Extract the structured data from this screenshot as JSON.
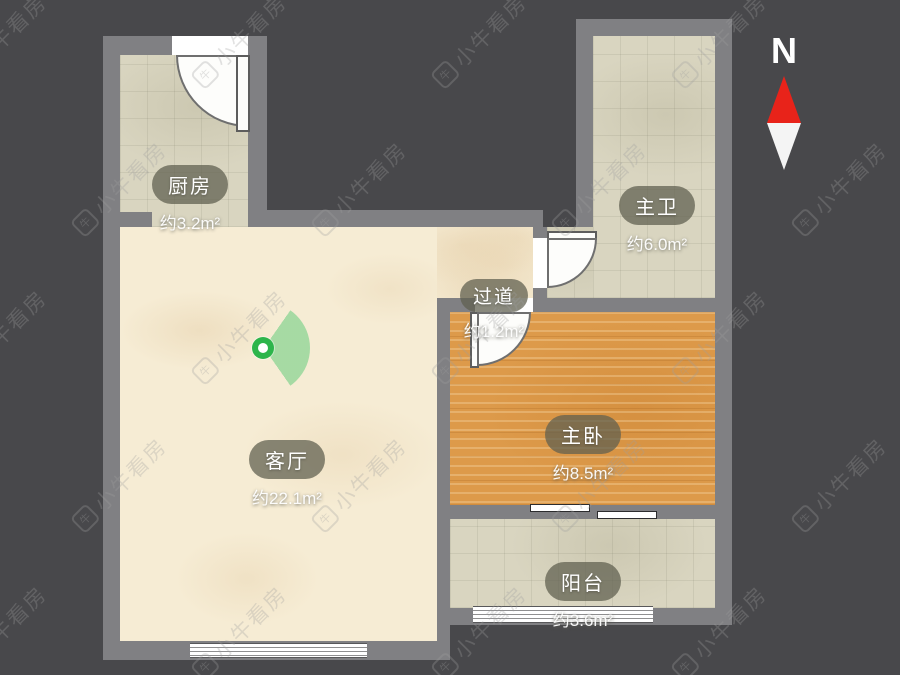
{
  "plan": {
    "rooms": [
      {
        "id": "kitchen",
        "name": "厨房",
        "area": "约3.2m²"
      },
      {
        "id": "bathroom",
        "name": "主卫",
        "area": "约6.0m²"
      },
      {
        "id": "hallway",
        "name": "过道",
        "area": "约1.2m²"
      },
      {
        "id": "living",
        "name": "客厅",
        "area": "约22.1m²"
      },
      {
        "id": "bedroom",
        "name": "主卧",
        "area": "约8.5m²"
      },
      {
        "id": "balcony",
        "name": "阳台",
        "area": "约3.6m²"
      }
    ],
    "compass": {
      "label": "N"
    },
    "watermark": {
      "text": "小牛看房",
      "icon_char": "牛"
    }
  },
  "colors": {
    "background": "#48484b",
    "wall": "#808083",
    "wood_floor": "#dd9a4a",
    "tile_floor": "#d9d5c0",
    "marble_floor": "#f6ecd4",
    "viewpoint_green": "#2db54b",
    "compass_red": "#e8231a"
  }
}
